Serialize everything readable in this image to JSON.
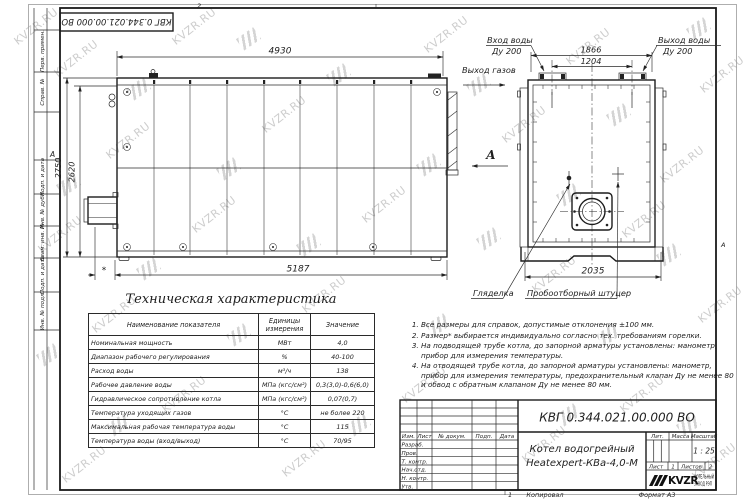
{
  "doc": {
    "number": "КВГ 0.344.021.00.000 ВО",
    "product_line1": "Котел водогрейный",
    "product_line2": "Heatexpert-КВа-4,0-М",
    "scale_value": "1 : 25",
    "sheet_value": "1",
    "sheets_value": "2",
    "copied_label": "Копировал",
    "format_label": "Формат А3",
    "company": {
      "logo_text": "KVZR",
      "line1": "КОТЕЛЬНЫЙ",
      "line2": "ЗАВОД РЭП"
    }
  },
  "titleblock": {
    "col_izm": "Изм.",
    "col_list": "Лист",
    "col_docnum": "№ докум.",
    "col_podp": "Подп.",
    "col_data": "Дата",
    "row_razrab": "Разраб.",
    "row_prov": "Пров.",
    "row_tkontr": "Т. контр.",
    "row_nachotd": "Нач.отд.",
    "row_nkontr": "Н. контр.",
    "row_utv": "Утв.",
    "lit_label": "Лит.",
    "mass_label": "Масса",
    "scale_label": "Масштаб",
    "sheet_label": "Лист",
    "sheets_label": "Листов"
  },
  "side_stamps": [
    "Перв. примен.",
    "Справ. №",
    "Подп. и дата",
    "Инв. № дубл.",
    "Взам. инв. №",
    "Подп. и дата",
    "Инв. № подл."
  ],
  "zones": {
    "top": "2",
    "bottom": "1",
    "left": "А",
    "right": "А"
  },
  "watermark": {
    "text": "KVZR.RU"
  },
  "drawing": {
    "dims": {
      "top_width": "4930",
      "height_outer": "2750",
      "height_inner": "2620",
      "bottom_length": "5187",
      "asterisk_dim": "*",
      "nozzle_span": "1866",
      "nozzle_pitch": "1204",
      "front_width": "2035"
    },
    "labels": {
      "water_in_1": "Вход воды",
      "water_in_2": "Ду 200",
      "water_out_1": "Выход воды",
      "water_out_2": "Ду 200",
      "gas_out": "Выход газов",
      "sight_glass": "Гляделка",
      "sampling": "Пробоотборный штуцер",
      "view": "А"
    }
  },
  "table": {
    "title": "Техническая характеристика",
    "headers": [
      "Наименование показателя",
      "Единицы измерения",
      "Значение"
    ],
    "rows": [
      [
        "Номинальная мощность",
        "МВт",
        "4,0"
      ],
      [
        "Диапазон рабочего регулирования",
        "%",
        "40-100"
      ],
      [
        "Расход воды",
        "м³/ч",
        "138"
      ],
      [
        "Рабочее давление воды",
        "МПа (кгс/см²)",
        "0,3(3,0)-0,6(6,0)"
      ],
      [
        "Гидравлическое сопротивление котла",
        "МПа (кгс/см²)",
        "0,07(0,7)"
      ],
      [
        "Температура уходящих газов",
        "°С",
        "не более 220"
      ],
      [
        "Максимальная рабочая температура воды",
        "°С",
        "115"
      ],
      [
        "Температура воды (вход/выход)",
        "°С",
        "70/95"
      ]
    ]
  },
  "notes": [
    "Все размеры для справок, допустимые отклонения ±100 мм.",
    "Размер* выбирается индивидуально согласно тех. требованиям горелки.",
    "На подводящей трубе котла, до запорной арматуры установлены: манометр, прибор для измерения температуры.",
    "На отводящей трубе котла, до запорной арматуры установлены: манометр, прибор для измерения температуры, предохранительный клапан Ду не менее 80 и обвод с обратным клапаном Ду не менее 80 мм."
  ]
}
